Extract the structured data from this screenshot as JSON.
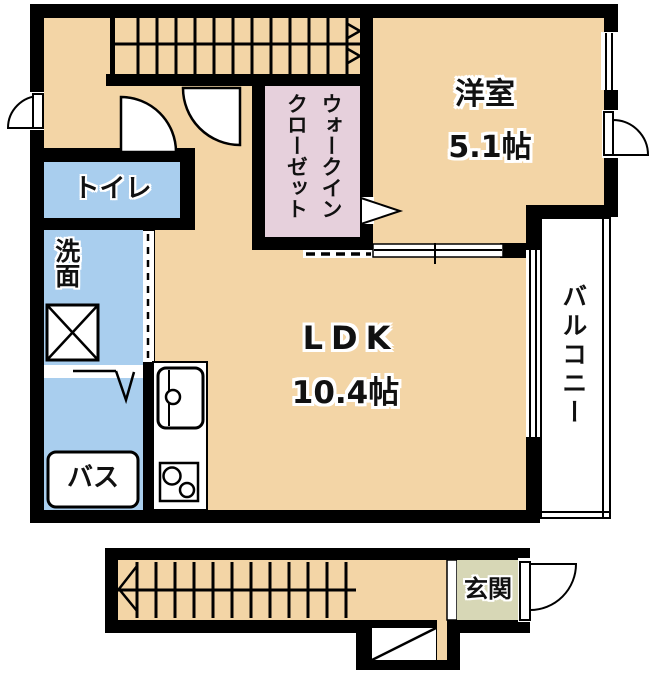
{
  "plan_title": "1LDK floor plan",
  "rooms": {
    "western": {
      "name": "洋室",
      "size": "5.1帖"
    },
    "ldk": {
      "name": "LDK",
      "size": "10.4帖"
    },
    "wic": {
      "name": "ウォークイン\nクローゼット"
    },
    "toilet": {
      "name": "トイレ"
    },
    "washroom": {
      "name": "洗面"
    },
    "bath": {
      "name": "バス"
    },
    "balcony": {
      "name": "バルコニー"
    },
    "entrance": {
      "name": "玄関"
    }
  },
  "colors": {
    "floor_tan": "#F3D5A6",
    "wet_area_blue": "#A9CEEE",
    "closet_pink": "#E6D0DC",
    "entrance_beige": "#D7D7B6",
    "wall_black": "#000000",
    "balcony_white": "#FFFFFF"
  }
}
